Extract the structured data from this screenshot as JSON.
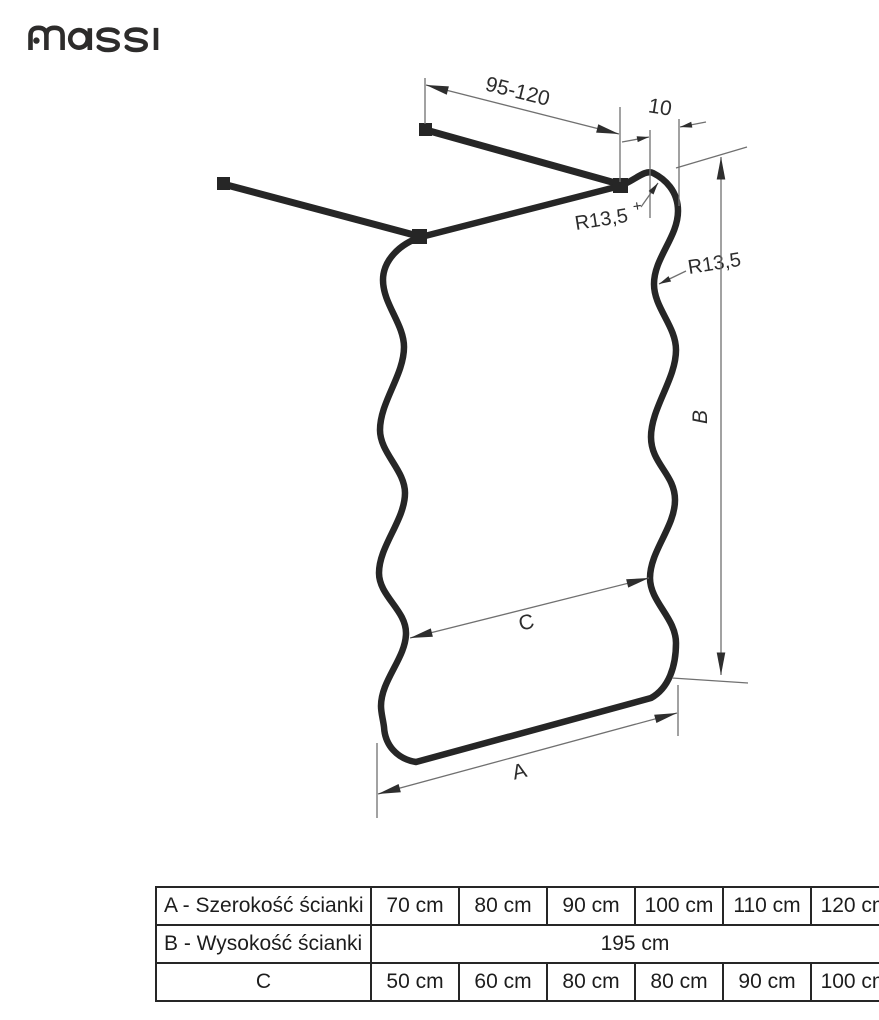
{
  "brand": {
    "name": "massi"
  },
  "drawing": {
    "labels": {
      "bar_range": "95-120",
      "offset": "10",
      "radius_top": "R13,5",
      "radius_top_mark": "+",
      "radius_side": "R13,5",
      "width": "A",
      "height": "B",
      "inner_width": "C"
    }
  },
  "table": {
    "rows": [
      {
        "label": "A - Szerokość ścianki",
        "values": [
          "70 cm",
          "80 cm",
          "90 cm",
          "100 cm",
          "110 cm",
          "120 cm"
        ]
      },
      {
        "label": "B - Wysokość ścianki",
        "merged_value": "195 cm"
      },
      {
        "label": "C",
        "values": [
          "50 cm",
          "60 cm",
          "80 cm",
          "80 cm",
          "90 cm",
          "100 cm"
        ]
      }
    ]
  }
}
